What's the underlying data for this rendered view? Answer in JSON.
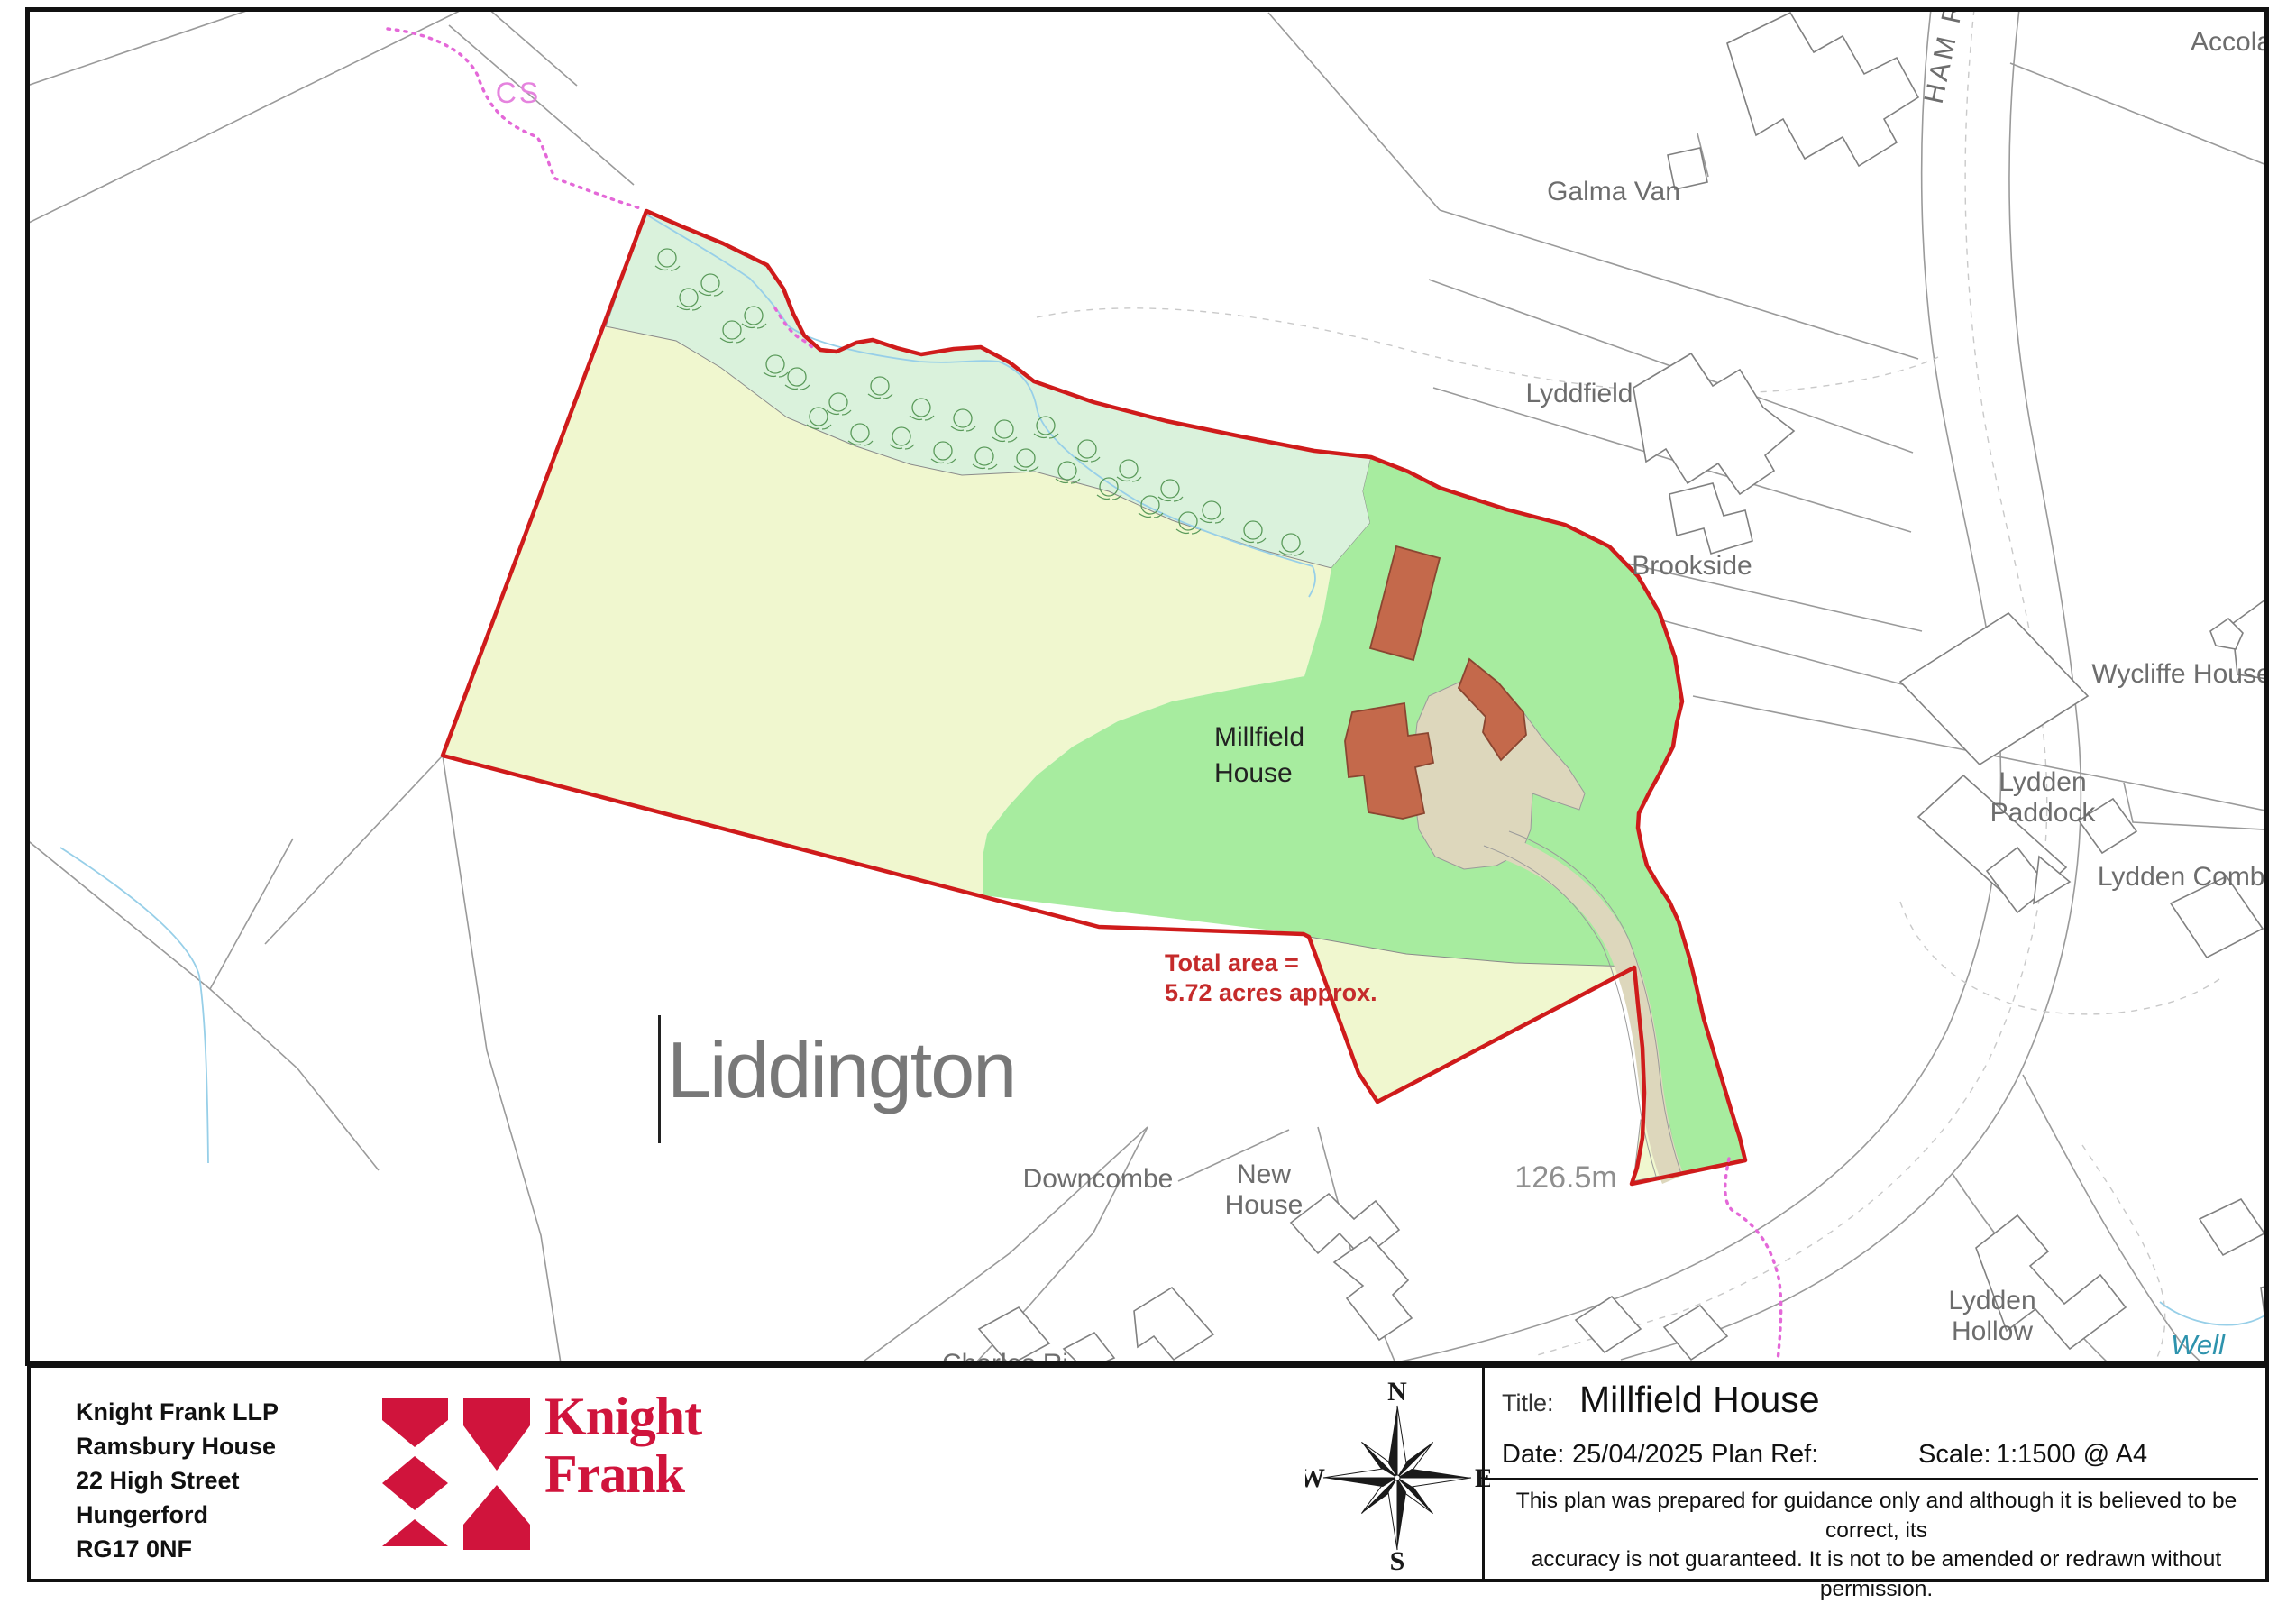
{
  "map": {
    "labels": {
      "cs": "CS",
      "galma_van": "Galma Van",
      "lyddfield": "Lyddfield",
      "brookside": "Brookside",
      "accolade": "Accolade",
      "ham_road": "HAM ROAD",
      "wycliffe_house": "Wycliffe House",
      "lydden_paddock_line1": "Lydden",
      "lydden_paddock_line2": "Paddock",
      "lydden_combe": "Lydden Combe",
      "millfield_house_line1": "Millfield",
      "millfield_house_line2": "House",
      "liddington": "Liddington",
      "total_area_line1": "Total area =",
      "total_area_line2": "5.72 acres approx.",
      "downcombe": "Downcombe",
      "new_house_line1": "New",
      "new_house_line2": "House",
      "spot_height": "126.5m",
      "lydden_hollow_line1": "Lydden",
      "lydden_hollow_line2": "Hollow",
      "well": "Well",
      "partial_street_label": "Charles Ri"
    },
    "colors": {
      "boundary_red": "#cf1b1b",
      "field_yellow": "#f0f7cf",
      "tree_belt_mint": "#daf2dc",
      "garden_green": "#a7ec9f",
      "driveway_beige": "#ddd7bc",
      "building_fill": "#c4694b",
      "footpath_pink": "#e468d8",
      "stream_blue": "#97cfe8",
      "annotation_red": "#c52b2b",
      "label_gray": "#6d6d6d",
      "well_teal": "#2e93ad"
    }
  },
  "title_block": {
    "address_lines": [
      "Knight Frank LLP",
      "Ramsbury House",
      "22 High Street",
      "Hungerford",
      "RG17 0NF"
    ],
    "logo": {
      "line1": "Knight",
      "line2": "Frank",
      "brand_red": "#d0143c"
    },
    "compass": {
      "north": "N",
      "east": "E",
      "south": "S",
      "west": "W"
    },
    "fields": {
      "title_label": "Title:",
      "title_value": "Millfield House",
      "date_label": "Date:",
      "date_value": "25/04/2025",
      "plan_ref_label": "Plan Ref:",
      "scale_label": "Scale:",
      "scale_value": "1:1500 @ A4"
    },
    "disclaimer_line1": "This plan was prepared for guidance only and although it is believed to be correct, its",
    "disclaimer_line2": "accuracy is not guaranteed.  It is not to be amended or redrawn without permission.",
    "copyright_line": "© Crown copyright and database rights 2025 OS100067005."
  }
}
